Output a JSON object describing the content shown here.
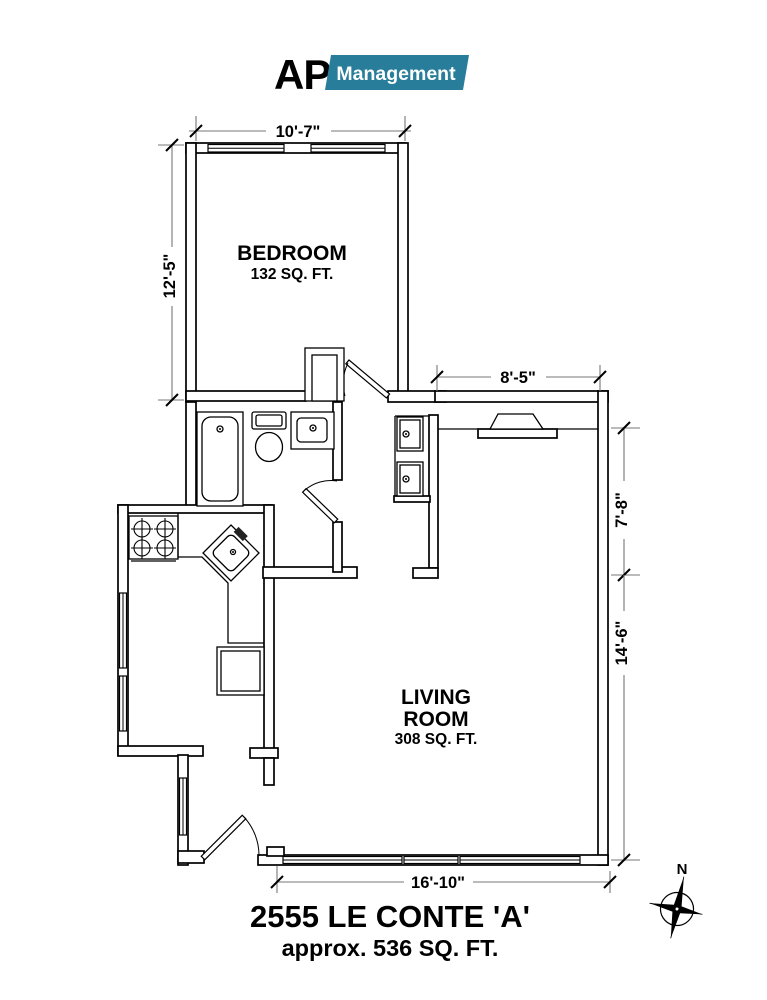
{
  "logo": {
    "prefix": "AP",
    "name": "Management"
  },
  "colors": {
    "banner": "#287e9a",
    "logo_prefix": "#58585a"
  },
  "rooms": {
    "bedroom": {
      "name": "BEDROOM",
      "area": "132 SQ. FT."
    },
    "living": {
      "name_line1": "LIVING",
      "name_line2": "ROOM",
      "area": "308 SQ. FT."
    }
  },
  "dimensions": {
    "bedroom_width": "10'-7\"",
    "bedroom_depth": "12'-5\"",
    "living_top_width": "8'-5\"",
    "living_right_upper": "7'-8\"",
    "living_right_lower": "14'-6\"",
    "bottom_width": "16'-10\""
  },
  "title": {
    "address": "2555 LE CONTE 'A'",
    "area_approx": "approx. 536 SQ. FT."
  },
  "compass": {
    "north": "N"
  }
}
